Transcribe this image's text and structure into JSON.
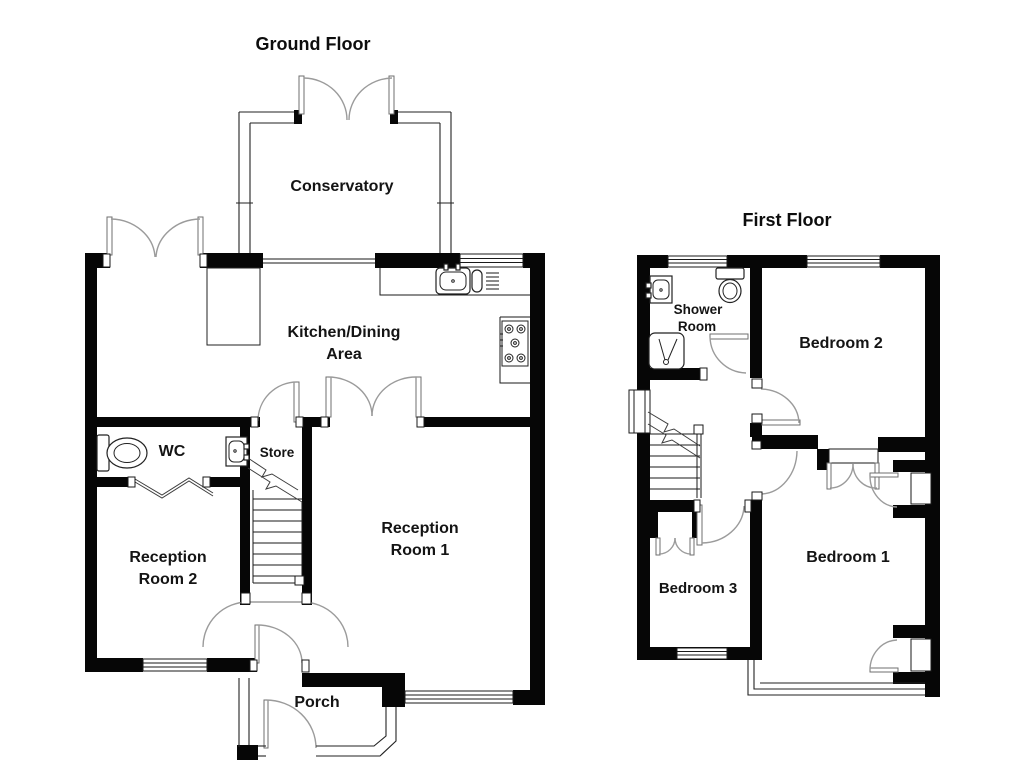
{
  "document": {
    "type": "floorplan",
    "background": "#ffffff"
  },
  "ground_floor": {
    "title": "Ground Floor",
    "rooms": {
      "conservatory": "Conservatory",
      "kitchen_line1": "Kitchen/Dining",
      "kitchen_line2": "Area",
      "wc": "WC",
      "store": "Store",
      "reception1_line1": "Reception",
      "reception1_line2": "Room 1",
      "reception2_line1": "Reception",
      "reception2_line2": "Room 2",
      "porch": "Porch"
    },
    "fixtures": [
      "toilet",
      "hand-basin",
      "kitchen-sink",
      "drainer",
      "hob",
      "kitchen-unit",
      "staircase"
    ]
  },
  "first_floor": {
    "title": "First Floor",
    "rooms": {
      "shower_line1": "Shower",
      "shower_line2": "Room",
      "bedroom1": "Bedroom 1",
      "bedroom2": "Bedroom 2",
      "bedroom3": "Bedroom 3"
    },
    "fixtures": [
      "hand-basin",
      "toilet",
      "shower-tray",
      "staircase",
      "built-in-wardrobes"
    ]
  },
  "colors": {
    "wall": "#060606",
    "door_swing": "#9b9b9b",
    "text": "#141414",
    "background": "#ffffff"
  }
}
